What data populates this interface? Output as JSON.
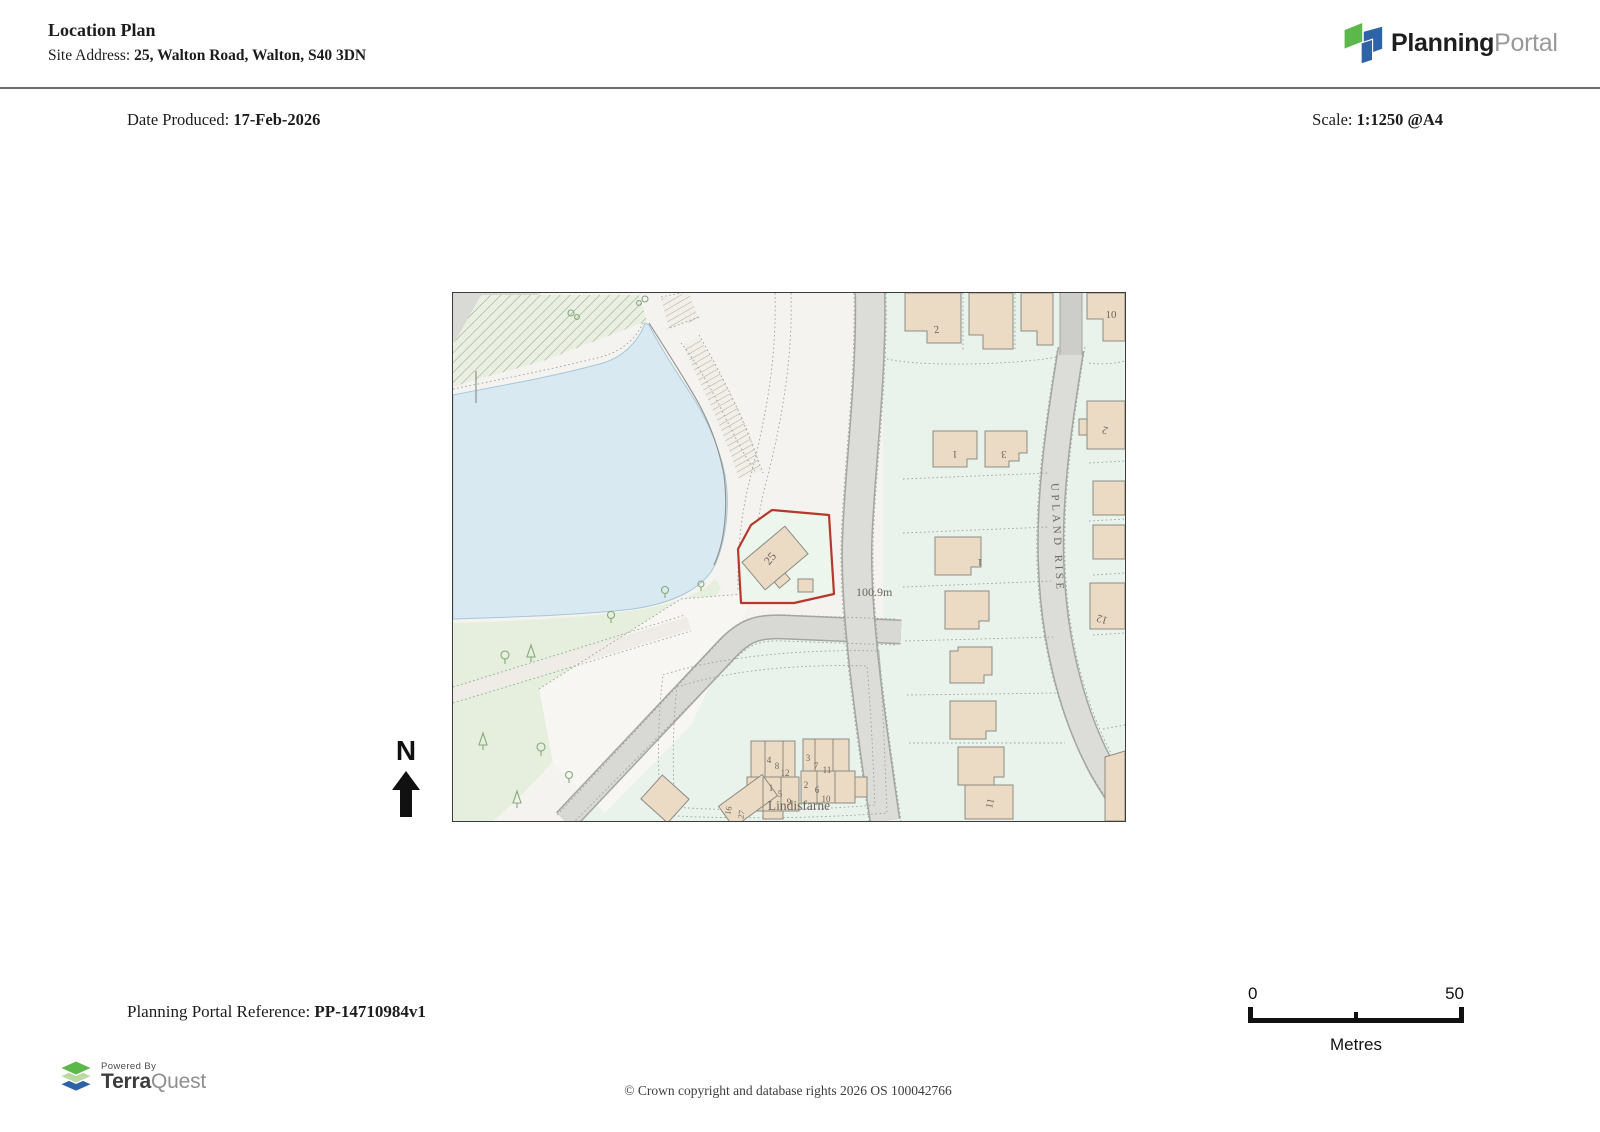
{
  "header": {
    "title": "Location Plan",
    "site_address_label": "Site Address: ",
    "site_address": "25, Walton Road, Walton, S40 3DN",
    "logo_part1": "Planning",
    "logo_part2": "Portal"
  },
  "meta": {
    "date_label": "Date Produced: ",
    "date_value": "17-Feb-2026",
    "scale_label": "Scale: ",
    "scale_value": "1:1250 @A4"
  },
  "map": {
    "north_label": "N",
    "labels": [
      {
        "t": "2",
        "x": 484,
        "y": 40,
        "r": -8,
        "s": 11
      },
      {
        "t": "10",
        "x": 658,
        "y": 25,
        "r": 0,
        "s": 11
      },
      {
        "t": "1",
        "x": 502,
        "y": 158,
        "r": 180,
        "s": 11
      },
      {
        "t": "3",
        "x": 551,
        "y": 158,
        "r": 180,
        "s": 11
      },
      {
        "t": "2",
        "x": 653,
        "y": 134,
        "r": 197,
        "s": 11
      },
      {
        "t": "1",
        "x": 527,
        "y": 266,
        "r": 180,
        "s": 11
      },
      {
        "t": "12",
        "x": 650,
        "y": 323,
        "r": 197,
        "s": 11
      },
      {
        "t": "11",
        "x": 540,
        "y": 511,
        "r": -78,
        "s": 10
      },
      {
        "t": "25",
        "x": 320,
        "y": 268,
        "r": -50,
        "s": 12
      },
      {
        "t": "100.9m",
        "x": 403,
        "y": 303,
        "r": 0,
        "s": 12,
        "a": "start"
      },
      {
        "t": "UPLAND RISE",
        "x": 601,
        "y": 245,
        "r": 87,
        "s": 11,
        "ls": 3.5
      },
      {
        "t": "Lindisfarne",
        "x": 346,
        "y": 517,
        "r": 0,
        "s": 13.5
      },
      {
        "t": "4",
        "x": 316,
        "y": 470,
        "r": 0,
        "s": 9
      },
      {
        "t": "8",
        "x": 324,
        "y": 476,
        "r": 0,
        "s": 9
      },
      {
        "t": "12",
        "x": 332,
        "y": 483,
        "r": 0,
        "s": 9
      },
      {
        "t": "1",
        "x": 318,
        "y": 498,
        "r": 0,
        "s": 9
      },
      {
        "t": "5",
        "x": 327,
        "y": 504,
        "r": 0,
        "s": 9
      },
      {
        "t": "9",
        "x": 336,
        "y": 512,
        "r": 0,
        "s": 9
      },
      {
        "t": "3",
        "x": 355,
        "y": 468,
        "r": 0,
        "s": 9
      },
      {
        "t": "7",
        "x": 363,
        "y": 476,
        "r": 0,
        "s": 9
      },
      {
        "t": "11",
        "x": 374,
        "y": 480,
        "r": 0,
        "s": 9
      },
      {
        "t": "2",
        "x": 353,
        "y": 495,
        "r": 0,
        "s": 9
      },
      {
        "t": "6",
        "x": 364,
        "y": 500,
        "r": 0,
        "s": 9
      },
      {
        "t": "10",
        "x": 373,
        "y": 509,
        "r": 0,
        "s": 9
      },
      {
        "t": "16",
        "x": 278,
        "y": 518,
        "r": -80,
        "s": 8.5
      },
      {
        "t": "27",
        "x": 291,
        "y": 522,
        "r": -80,
        "s": 8.5
      }
    ]
  },
  "scalebar": {
    "start_label": "0",
    "end_label": "50",
    "units_label": "Metres"
  },
  "footer": {
    "reference_label": "Planning Portal Reference: ",
    "reference_value": "PP-14710984v1",
    "powered_by_label": "Powered By",
    "terraquest_part1": "Terra",
    "terraquest_part2": "Quest",
    "copyright": "© Crown copyright and database rights 2026 OS 100042766"
  },
  "colors": {
    "site_boundary": "#b6372c",
    "water": "#d9e9f1",
    "building": "#ecdbc4",
    "road": "#dcdcd8",
    "greenspace": "#e6eedd",
    "plot_mint": "#e9f3ec",
    "brand_green": "#5cb84a",
    "brand_blue": "#2d63a7"
  }
}
